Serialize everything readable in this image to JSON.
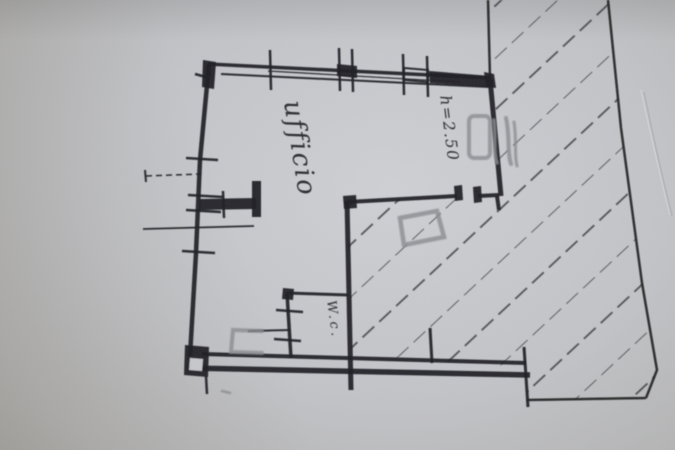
{
  "labels": {
    "room_name": "ufficio",
    "ceiling_height": "h=2.50",
    "wc": "W.c."
  },
  "colors": {
    "paper-light": "#cfd0d4",
    "paper-mid": "#c2c3c7",
    "paper-dark": "#a7a6a3",
    "ink": "#202023",
    "pencil": "#8a8b8f",
    "hatch": "#3b3b40",
    "text-ink": "#2b2b2f"
  }
}
